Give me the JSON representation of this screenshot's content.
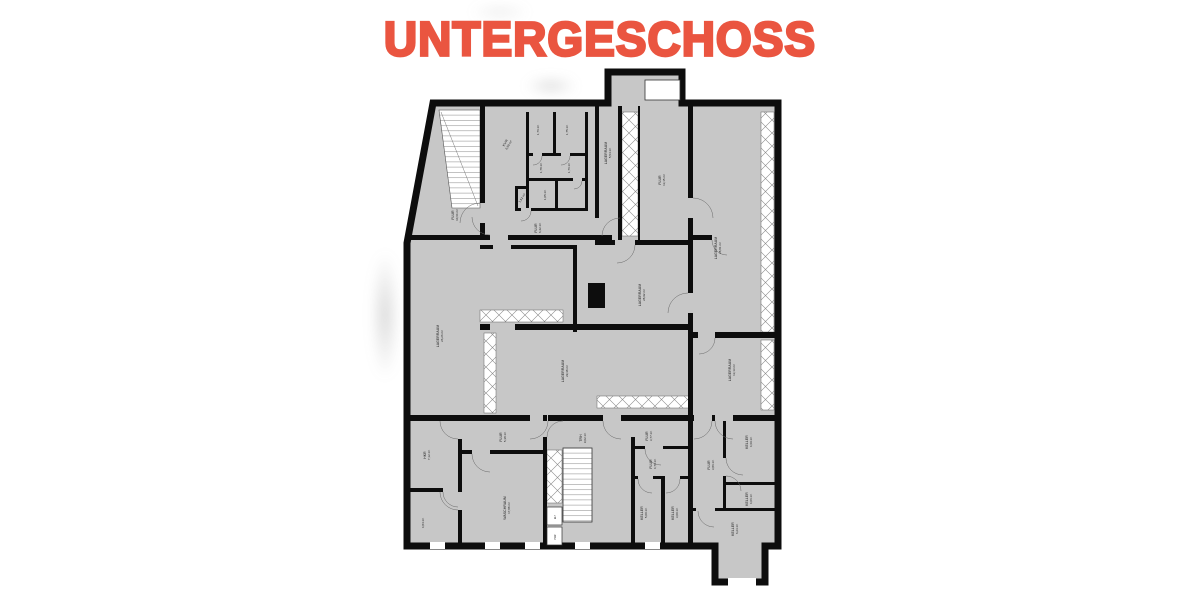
{
  "title": "UNTERGESCHOSS",
  "colors": {
    "accent": "#ea5540",
    "floor": "#c7c7c7",
    "walls": "#0d0d0d"
  },
  "floor_plan": {
    "floor_name": "UNTERGESCHOSS",
    "rooms": [
      {
        "id": "flur-a",
        "name": "FLUR",
        "area": "10,64 m²"
      },
      {
        "id": "kvr",
        "name": "KVR",
        "area": "6,69 m²"
      },
      {
        "id": "cell-a",
        "name": "",
        "area": "1,76 m²"
      },
      {
        "id": "cell-b",
        "name": "",
        "area": "1,75 m²"
      },
      {
        "id": "cell-c",
        "name": "",
        "area": "1,78 m²"
      },
      {
        "id": "cell-d",
        "name": "",
        "area": "1,76 m²"
      },
      {
        "id": "cell-e",
        "name": "",
        "area": "1,52 m²"
      },
      {
        "id": "cell-f",
        "name": "",
        "area": "1,05 m²"
      },
      {
        "id": "flur-b",
        "name": "FLUR",
        "area": "6,42 m²"
      },
      {
        "id": "lager-a",
        "name": "LAGERRAUM",
        "area": "5,54 m²"
      },
      {
        "id": "flur-c",
        "name": "FLUR",
        "area": "13,15 m²"
      },
      {
        "id": "lager-b",
        "name": "LAGERRAUM",
        "area": "28,81 m²"
      },
      {
        "id": "lager-c",
        "name": "LAGERRAUM",
        "area": "28,92 m²"
      },
      {
        "id": "lager-d",
        "name": "LAGERRAUM",
        "area": "26,26 m²"
      },
      {
        "id": "lager-e",
        "name": "LAGERRAUM",
        "area": "29,38 m²"
      },
      {
        "id": "lager-f",
        "name": "LAGERRAUM",
        "area": "13,13 m²"
      },
      {
        "id": "hkr",
        "name": "HKR",
        "area": "7,12 m²"
      },
      {
        "id": "room-484",
        "name": "",
        "area": "4,84 m²"
      },
      {
        "id": "flur-d",
        "name": "FLUR",
        "area": "5,38 m²"
      },
      {
        "id": "waschraum",
        "name": "WASCHRAUM",
        "area": "17,88 m²"
      },
      {
        "id": "trh",
        "name": "TRH",
        "area": "9,02 m²"
      },
      {
        "id": "flur-e",
        "name": "FLUR",
        "area": "3,77 m²"
      },
      {
        "id": "flur-f",
        "name": "FLUR",
        "area": "4,70 m²"
      },
      {
        "id": "keller-a",
        "name": "KELLER",
        "area": "5,00 m²"
      },
      {
        "id": "keller-b",
        "name": "KELLER",
        "area": "3,00 m²"
      },
      {
        "id": "flur-g",
        "name": "FLUR",
        "area": "3,86 m²"
      },
      {
        "id": "keller-c",
        "name": "KELLER",
        "area": "4,69 m²"
      },
      {
        "id": "keller-d",
        "name": "KELLER",
        "area": "4,06 m²"
      },
      {
        "id": "keller-e",
        "name": "KELLER",
        "area": "6,23 m²"
      },
      {
        "id": "elt",
        "name": "ELT",
        "area": ""
      },
      {
        "id": "har",
        "name": "HAR",
        "area": ""
      }
    ]
  }
}
